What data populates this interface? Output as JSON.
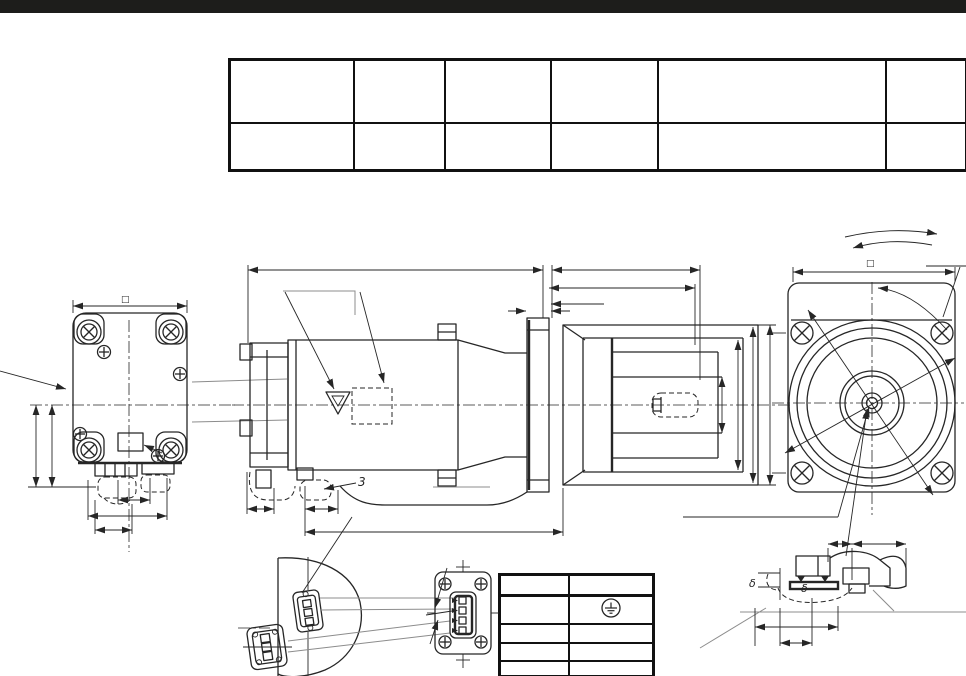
{
  "page": {
    "background": "#ffffff",
    "top_bar_color": "#1d1d1b"
  },
  "title_block": {
    "rows": [
      [
        "",
        "",
        "",
        "",
        "",
        ""
      ],
      [
        "",
        "",
        "",
        "",
        "",
        ""
      ]
    ]
  },
  "pin_table": {
    "rows": [
      [
        "",
        ""
      ],
      [
        "",
        ""
      ],
      [
        "",
        ""
      ],
      [
        "",
        ""
      ],
      [
        "",
        ""
      ]
    ]
  },
  "symbols": {
    "rear_square_mark": "□",
    "front_square_mark": "□",
    "side_leader_label": "3",
    "detail_delta_label_1": "δ",
    "detail_delta_label_2": "δ",
    "ground_symbol": "⏚"
  }
}
